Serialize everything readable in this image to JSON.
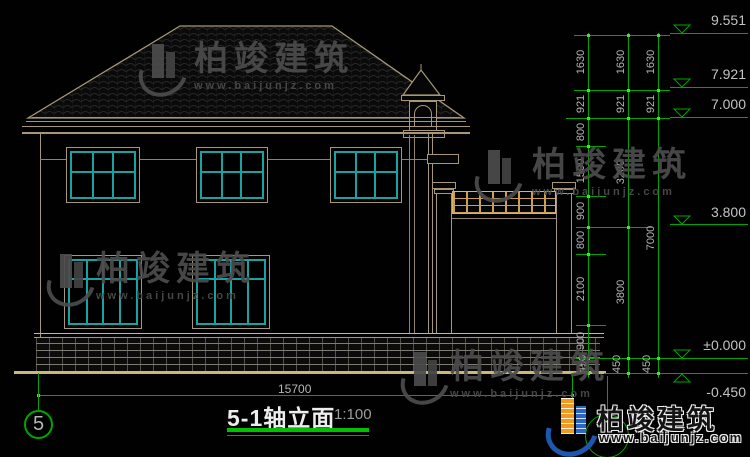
{
  "title": {
    "name": "5-1轴立面",
    "scale": "1:100",
    "axis_bubble": "5"
  },
  "elevation_markers": [
    "9.551",
    "7.921",
    "7.000",
    "3.800",
    "±0.000",
    "-0.450"
  ],
  "dim_chains": {
    "inner": [
      "1630",
      "921",
      "800",
      "1500",
      "900",
      "800",
      "2100",
      "900",
      "450"
    ],
    "middle": [
      "1630",
      "921",
      "3200",
      "3800",
      "450"
    ],
    "outer": [
      "1630",
      "921",
      "7000",
      "450"
    ],
    "bottom_width": "15700"
  },
  "watermark": {
    "brand": "柏竣建筑",
    "url": "www.baijunjz.com"
  },
  "colors": {
    "dim_green": "#00a600",
    "cad_tan": "#a6977a",
    "window_teal": "#18a2a2",
    "dim_text_gray": "#b5b5b5",
    "lattice_gold": "#caa152",
    "logo_blue": "#1c57b0",
    "logo_orange": "#f09a20",
    "ground_tan": "#c9b87e"
  }
}
